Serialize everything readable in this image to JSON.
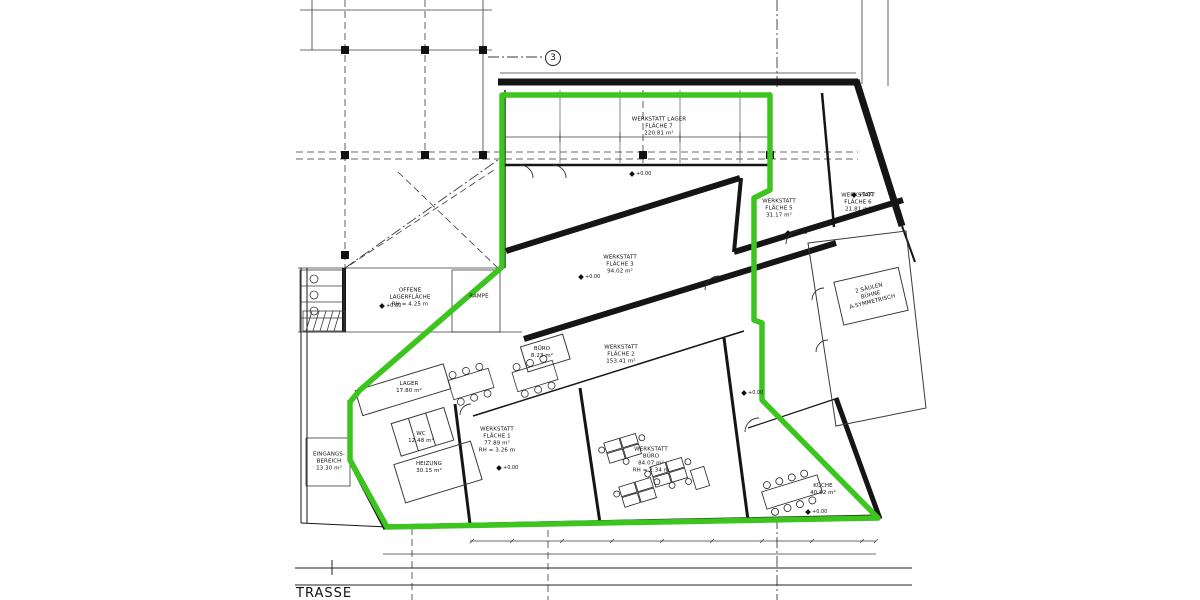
{
  "meta": {
    "drawing_type": "Grundriss / Werkstatt-Mietfläche",
    "language": "de"
  },
  "colors": {
    "highlight_green": "#3cc51f",
    "line_black": "#151515",
    "line_gray": "#3a3a3a",
    "background": "#ffffff"
  },
  "street_label": "TRASSE",
  "grid_marker": "3",
  "level_marker": "+0.00",
  "rooms": [
    {
      "id": "werkstatt-lager-flaeche-7",
      "label": "WERKSTATT LAGER\nFLÄCHE 7\n220.81 m²"
    },
    {
      "id": "werkstatt-flaeche-3",
      "label": "WERKSTATT\nFLÄCHE 3\n94.02 m²"
    },
    {
      "id": "werkstatt-flaeche-2",
      "label": "WERKSTATT\nFLÄCHE 2\n153.41 m²"
    },
    {
      "id": "werkstatt-flaeche-1",
      "label": "WERKSTATT\nFLÄCHE 1\n77.89 m²\nRH = 3.26 m"
    },
    {
      "id": "werkstatt-buero",
      "label": "WERKSTATT\nBÜRO\n84.07 m²\nRH = 2.34 m"
    },
    {
      "id": "werkstatt-flaeche-5",
      "label": "WERKSTATT\nFLÄCHE 5\n31.17 m²"
    },
    {
      "id": "werkstatt-flaeche-6",
      "label": "WERKSTATT\nFLÄCHE 6\n21.81 m²"
    },
    {
      "id": "offene-lagerflaeche",
      "label": "OFFENE\nLAGERFLÄCHE\nRH = 4.25 m"
    },
    {
      "id": "rampe",
      "label": "RAMPE"
    },
    {
      "id": "lager",
      "label": "LAGER\n17.80 m²"
    },
    {
      "id": "wc",
      "label": "WC\n12.48 m²"
    },
    {
      "id": "heizung",
      "label": "HEIZUNG\n30.15 m²"
    },
    {
      "id": "eingangsbereich",
      "label": "EINGANGS-\nBEREICH\n13.30 m²"
    },
    {
      "id": "kueche",
      "label": "KÜCHE\n40.82 m²"
    },
    {
      "id": "buero-klein",
      "label": "BÜRO\n8.23 m²"
    },
    {
      "id": "buehne",
      "label": "2 SÄULEN\nBÜHNE\nA-SYMMETRISCH"
    }
  ]
}
